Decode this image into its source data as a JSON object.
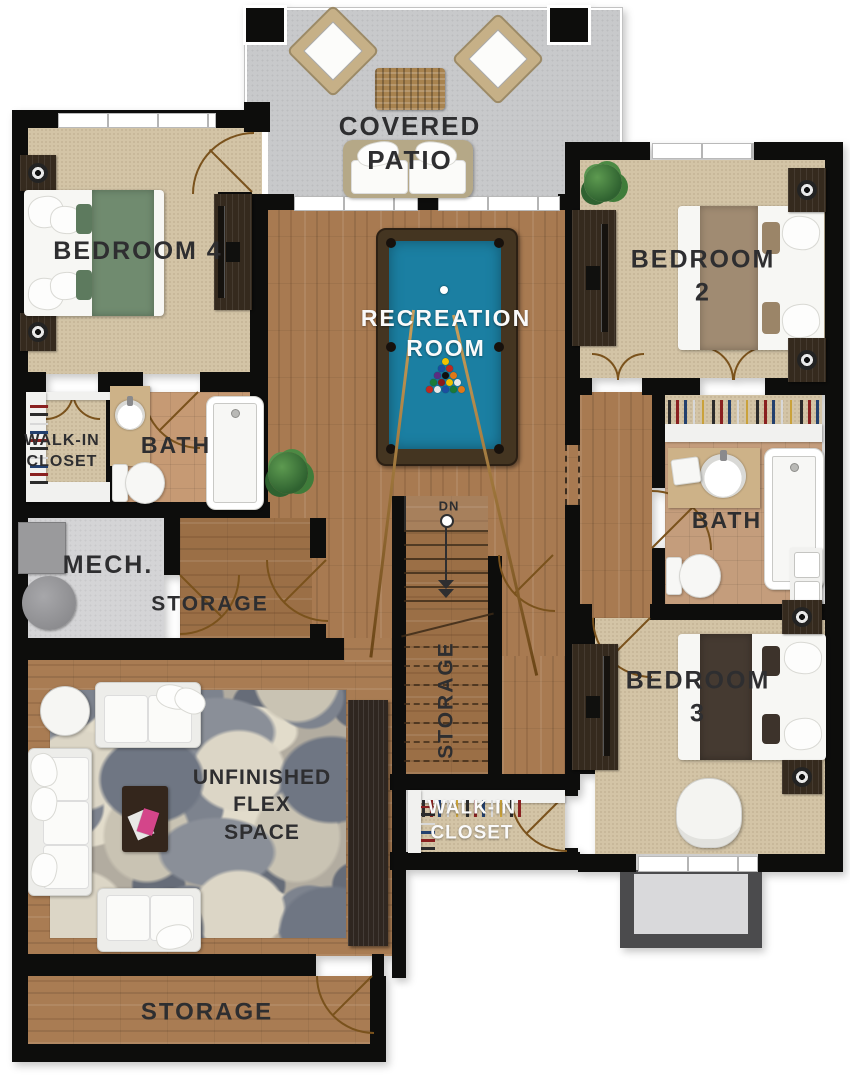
{
  "plan_title": "basement-floor-plan",
  "rooms": {
    "covered_patio": {
      "label": "COVERED\nPATIO"
    },
    "bedroom4": {
      "label": "BEDROOM 4"
    },
    "bedroom2": {
      "label": "BEDROOM 2"
    },
    "recreation_room": {
      "label": "RECREATION\nROOM"
    },
    "walk_in_closet_left": {
      "label": "WALK-IN\nCLOSET"
    },
    "bath_left": {
      "label": "BATH"
    },
    "mech": {
      "label": "MECH."
    },
    "storage_left": {
      "label": "STORAGE"
    },
    "bath_right": {
      "label": "BATH"
    },
    "bedroom3": {
      "label": "BEDROOM 3"
    },
    "stair_storage": {
      "label": "STORAGE"
    },
    "walk_in_closet_bottom": {
      "label": "WALK-IN\nCLOSET"
    },
    "flex_space": {
      "label": "UNFINISHED\nFLEX\nSPACE"
    },
    "storage_bottom": {
      "label": "STORAGE"
    }
  },
  "stairs": {
    "direction_label": "DN"
  },
  "palette": {
    "wall": "#0d0d0c",
    "wood_floor": "#a87a51",
    "carpet": "#d3c4a6",
    "tile": "#c69a74",
    "patio_concrete": "#c8c9cb",
    "mech_floor": "#d4d4d6",
    "pool_felt": "#1b7fa2",
    "pool_rail": "#443521",
    "bed4_accent": "#708b6f",
    "bed2_accent": "#a08b72",
    "bed3_accent": "#453a31",
    "door_arc": "#7a521c",
    "label_dark": "#2e2e30",
    "label_light": "#fafafa"
  }
}
